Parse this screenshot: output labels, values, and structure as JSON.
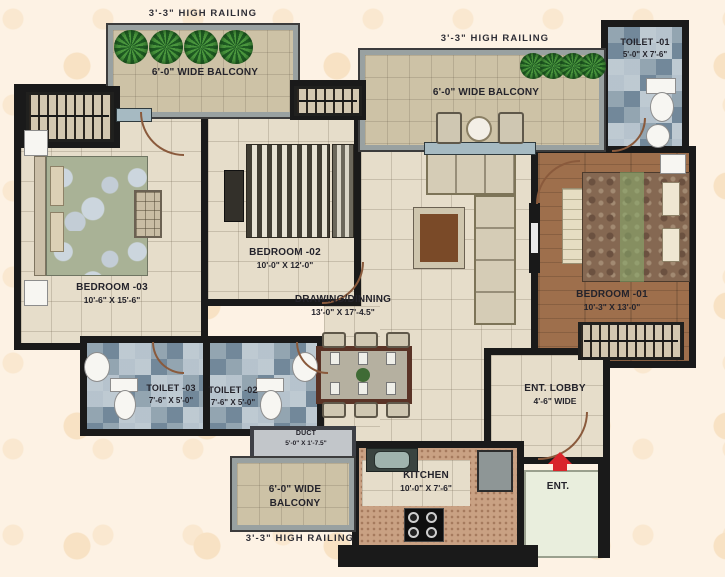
{
  "labels": {
    "railings": [
      "3'-3\" HIGH RAILING",
      "3'-3\" HIGH RAILING",
      "3'-3\" HIGH RAILING"
    ],
    "entrance": "ENT."
  },
  "rooms": {
    "balcony_top_left": {
      "name": "6'-0\" WIDE BALCONY"
    },
    "balcony_top_mid": {
      "name": "6'-0\" WIDE BALCONY"
    },
    "balcony_bottom": {
      "line1": "6'-0\" WIDE",
      "line2": "BALCONY"
    },
    "toilet_01": {
      "name": "TOILET -01",
      "dims": "5'-0\" X 7'-6\""
    },
    "toilet_02": {
      "name": "TOILET -02",
      "dims": "7'-6\" X 5'-0\""
    },
    "toilet_03": {
      "name": "TOILET -03",
      "dims": "7'-6\" X 5'-0\""
    },
    "bedroom_01": {
      "name": "BEDROOM -01",
      "dims": "10'-3\" X 13'-0\""
    },
    "bedroom_02": {
      "name": "BEDROOM -02",
      "dims": "10'-0\" X 12'-0\""
    },
    "bedroom_03": {
      "name": "BEDROOM -03",
      "dims": "10'-6\" X 15'-6\""
    },
    "drawing_dining": {
      "name": "DRAWING/DINNING",
      "dims": "13'-0\" X 17'-4.5\""
    },
    "kitchen": {
      "name": "KITCHEN",
      "dims": "10'-0\" X 7'-6\""
    },
    "ent_lobby": {
      "name": "ENT. LOBBY",
      "dims": "4'-6\" WIDE"
    },
    "duct": {
      "name": "DUCT",
      "dims": "5'-0\" X 1'-7.5\""
    }
  },
  "colors": {
    "wall": "#1a1a1a",
    "floor_tile": "#e6ddca",
    "balcony_floor": "#cdc2a6",
    "toilet_tile": "#7e93a3",
    "wood_floor": "#9e6f4c",
    "entrance_pad": "#e9eedd",
    "entry_arrow_red": "#d9252b",
    "plant_green": "#2f7d33",
    "background": "#fdf2e4"
  }
}
